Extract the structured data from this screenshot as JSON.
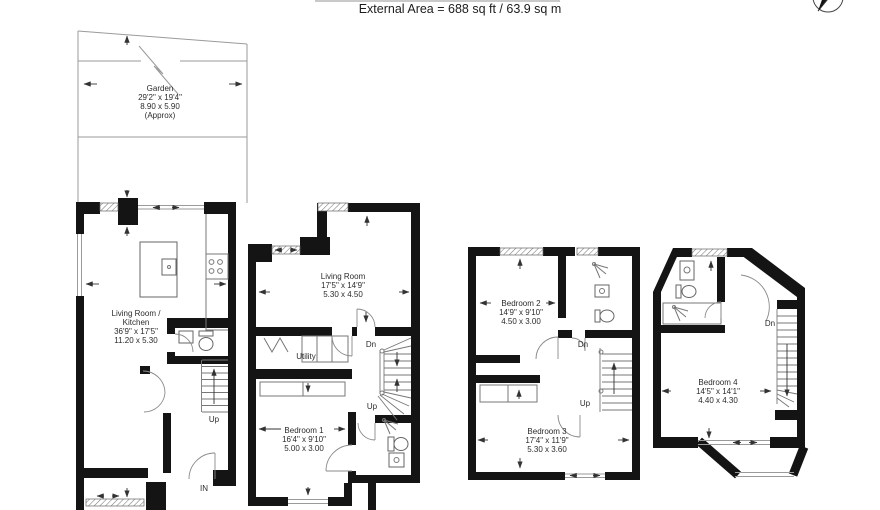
{
  "header": {
    "external_area": "External Area = 688 sq ft / 63.9 sq m"
  },
  "garden": {
    "title": "Garden",
    "imperial": "29'2\" x 19'4\"",
    "metric": "8.90 x 5.90",
    "approx": "(Approx)"
  },
  "ground_floor": {
    "room_line1": "Living Room /",
    "room_line2": "Kitchen",
    "imperial": "36'9\" x 17'5\"",
    "metric": "11.20 x 5.30"
  },
  "first_floor": {
    "living_room": "Living Room",
    "living_imperial": "17'5\" x 14'9\"",
    "living_metric": "5.30 x 4.50",
    "utility": "Utility",
    "bedroom1": "Bedroom 1",
    "bedroom1_imperial": "16'4\" x 9'10\"",
    "bedroom1_metric": "5.00 x 3.00"
  },
  "second_floor": {
    "bedroom2": "Bedroom 2",
    "bedroom2_imperial": "14'9\" x 9'10\"",
    "bedroom2_metric": "4.50 x 3.00",
    "bedroom3": "Bedroom 3",
    "bedroom3_imperial": "17'4\" x 11'9\"",
    "bedroom3_metric": "5.30 x 3.60"
  },
  "third_floor": {
    "bedroom4": "Bedroom 4",
    "bedroom4_imperial": "14'5\" x 14'1\"",
    "bedroom4_metric": "4.40 x 4.30"
  },
  "labels": {
    "up": "Up",
    "dn": "Dn",
    "in": "IN"
  },
  "colors": {
    "wall": "#141414",
    "line": "#777777",
    "text": "#2b2b2b"
  }
}
